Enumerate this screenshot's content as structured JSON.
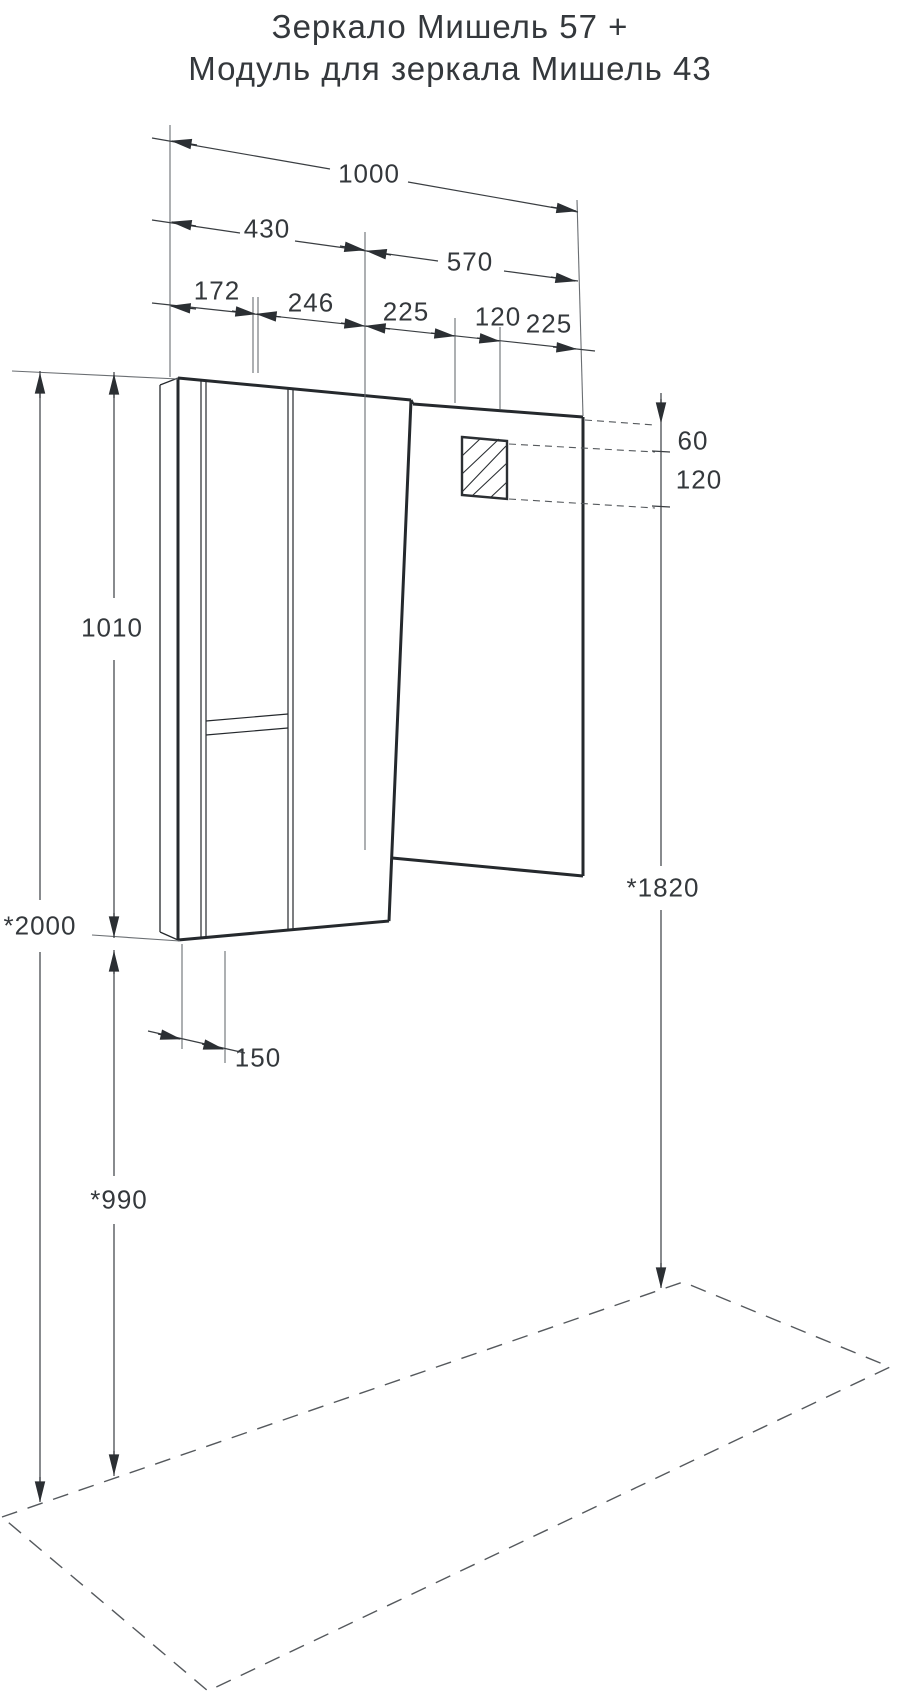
{
  "title": {
    "line1": "Зеркало Мишель 57 +",
    "line2": "Модуль для зеркала Мишель 43"
  },
  "dimensions": {
    "total_width": "1000",
    "module_width": "430",
    "mirror_width": "570",
    "top_segments": [
      "172",
      "246",
      "225",
      "120",
      "225"
    ],
    "outlet_offset_top": "60",
    "outlet_height": "120",
    "module_height": "1010",
    "mounting_height_total": "*2000",
    "mirror_top_height": "*1820",
    "module_depth": "150",
    "module_bottom_height": "*990"
  },
  "colors": {
    "line": "#2b2f33",
    "text": "#34383c",
    "background": "#ffffff"
  }
}
